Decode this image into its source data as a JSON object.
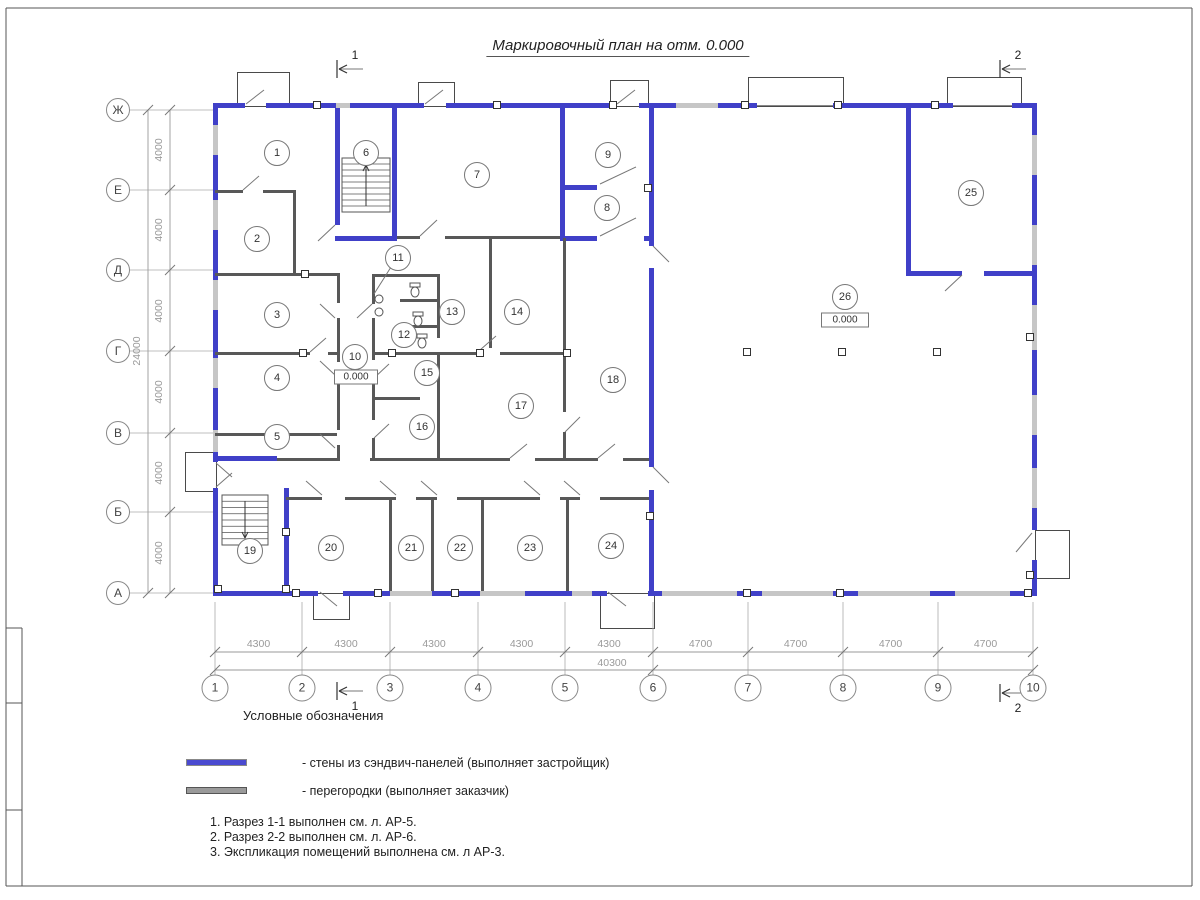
{
  "sheet": {
    "title": "Маркировочный план на отм. 0.000"
  },
  "legend": {
    "heading": "Условные обозначения",
    "items": [
      {
        "name": "sandwich-walls",
        "color": "#4040c8",
        "label": "- стены из сэндвич-панелей (выполняет застройщик)"
      },
      {
        "name": "partitions",
        "color": "#9a9a9a",
        "label": "- перегородки (выполняет заказчик)"
      }
    ]
  },
  "notes": [
    "1. Разрез 1-1 выполнен см. л. АР-5.",
    "2. Разрез 2-2 выполнен см. л. АР-6.",
    "3. Экспликация помещений выполнена см. л АР-3."
  ],
  "axes": {
    "rows": [
      {
        "label": "Ж",
        "y": 110
      },
      {
        "label": "Е",
        "y": 190
      },
      {
        "label": "Д",
        "y": 270
      },
      {
        "label": "Г",
        "y": 351
      },
      {
        "label": "В",
        "y": 433
      },
      {
        "label": "Б",
        "y": 512
      },
      {
        "label": "А",
        "y": 593
      }
    ],
    "cols": [
      {
        "label": "1",
        "x": 215
      },
      {
        "label": "2",
        "x": 302
      },
      {
        "label": "3",
        "x": 390
      },
      {
        "label": "4",
        "x": 478
      },
      {
        "label": "5",
        "x": 565
      },
      {
        "label": "6",
        "x": 653
      },
      {
        "label": "7",
        "x": 748
      },
      {
        "label": "8",
        "x": 843
      },
      {
        "label": "9",
        "x": 938
      },
      {
        "label": "10",
        "x": 1033
      }
    ]
  },
  "dimensions": {
    "bottom": {
      "seg_labels": [
        "4300",
        "4300",
        "4300",
        "4300",
        "4300",
        "4700",
        "4700",
        "4700",
        "4700"
      ],
      "total_label": "40300",
      "chain_y": 652,
      "total_y": 670,
      "total_label_x": 612
    },
    "left": {
      "seg_labels": [
        "4000",
        "4000",
        "4000",
        "4000",
        "4000",
        "4000"
      ],
      "total_label": "24000",
      "chain_x": 170,
      "total_x": 148,
      "total_label_y": 351
    }
  },
  "sections": [
    {
      "label": "1",
      "x": 337,
      "y": 69,
      "side": "top"
    },
    {
      "label": "2",
      "x": 1000,
      "y": 69,
      "side": "top"
    },
    {
      "label": "1",
      "x": 337,
      "y": 691,
      "side": "bottom"
    },
    {
      "label": "2",
      "x": 1000,
      "y": 693,
      "side": "bottom"
    }
  ],
  "elevations": [
    {
      "text": "0.000",
      "x": 356,
      "y": 377,
      "w": 36
    },
    {
      "text": "0.000",
      "x": 845,
      "y": 320,
      "w": 40
    }
  ],
  "rooms": [
    {
      "n": "1",
      "x": 277,
      "y": 153
    },
    {
      "n": "2",
      "x": 257,
      "y": 239
    },
    {
      "n": "3",
      "x": 277,
      "y": 315
    },
    {
      "n": "4",
      "x": 277,
      "y": 378
    },
    {
      "n": "5",
      "x": 277,
      "y": 437
    },
    {
      "n": "6",
      "x": 366,
      "y": 153
    },
    {
      "n": "7",
      "x": 477,
      "y": 175
    },
    {
      "n": "8",
      "x": 607,
      "y": 208
    },
    {
      "n": "9",
      "x": 608,
      "y": 155
    },
    {
      "n": "10",
      "x": 355,
      "y": 357
    },
    {
      "n": "11",
      "x": 398,
      "y": 258
    },
    {
      "n": "12",
      "x": 404,
      "y": 335
    },
    {
      "n": "13",
      "x": 452,
      "y": 312
    },
    {
      "n": "14",
      "x": 517,
      "y": 312
    },
    {
      "n": "15",
      "x": 427,
      "y": 373
    },
    {
      "n": "16",
      "x": 422,
      "y": 427
    },
    {
      "n": "17",
      "x": 521,
      "y": 406
    },
    {
      "n": "18",
      "x": 613,
      "y": 380
    },
    {
      "n": "19",
      "x": 250,
      "y": 551
    },
    {
      "n": "20",
      "x": 331,
      "y": 548
    },
    {
      "n": "21",
      "x": 411,
      "y": 548
    },
    {
      "n": "22",
      "x": 460,
      "y": 548
    },
    {
      "n": "23",
      "x": 530,
      "y": 548
    },
    {
      "n": "24",
      "x": 611,
      "y": 546
    },
    {
      "n": "25",
      "x": 971,
      "y": 193
    },
    {
      "n": "26",
      "x": 845,
      "y": 297
    }
  ],
  "geometry": {
    "frame": [
      [
        6,
        8,
        1192,
        8
      ],
      [
        6,
        8,
        6,
        886
      ],
      [
        1192,
        8,
        1192,
        886
      ],
      [
        6,
        886,
        1192,
        886
      ],
      [
        22,
        628,
        22,
        886
      ],
      [
        6,
        628,
        22,
        628
      ],
      [
        6,
        703,
        22,
        703
      ],
      [
        6,
        810,
        22,
        810
      ]
    ],
    "canopies": [
      [
        237,
        72,
        51,
        33
      ],
      [
        418,
        82,
        35,
        23
      ],
      [
        610,
        80,
        37,
        25
      ],
      [
        748,
        77,
        94,
        28
      ],
      [
        947,
        77,
        73,
        28
      ],
      [
        185,
        452,
        30,
        38
      ],
      [
        1035,
        530,
        33,
        47
      ],
      [
        313,
        593,
        35,
        25
      ],
      [
        600,
        593,
        53,
        34
      ]
    ],
    "windows": [
      [
        336,
        103,
        14,
        5
      ],
      [
        676,
        103,
        42,
        5
      ],
      [
        213,
        125,
        5,
        30
      ],
      [
        213,
        200,
        5,
        30
      ],
      [
        213,
        280,
        5,
        30
      ],
      [
        213,
        358,
        5,
        30
      ],
      [
        213,
        430,
        5,
        22
      ],
      [
        1032,
        135,
        5,
        40
      ],
      [
        1032,
        225,
        5,
        40
      ],
      [
        1032,
        305,
        5,
        45
      ],
      [
        1032,
        395,
        5,
        40
      ],
      [
        1032,
        468,
        5,
        40
      ],
      [
        390,
        591,
        42,
        5
      ],
      [
        480,
        591,
        45,
        5
      ],
      [
        572,
        591,
        20,
        5
      ],
      [
        662,
        591,
        75,
        5
      ],
      [
        762,
        591,
        71,
        5
      ],
      [
        858,
        591,
        72,
        5
      ],
      [
        955,
        591,
        55,
        5
      ]
    ],
    "walls_blue": [
      [
        215,
        103,
        30,
        5
      ],
      [
        266,
        103,
        70,
        5
      ],
      [
        350,
        103,
        74,
        5
      ],
      [
        446,
        103,
        170,
        5
      ],
      [
        639,
        103,
        37,
        5
      ],
      [
        718,
        103,
        39,
        5
      ],
      [
        833,
        103,
        120,
        5
      ],
      [
        1012,
        103,
        25,
        5
      ],
      [
        213,
        103,
        5,
        22
      ],
      [
        213,
        155,
        5,
        45
      ],
      [
        213,
        230,
        5,
        50
      ],
      [
        213,
        310,
        5,
        48
      ],
      [
        213,
        388,
        5,
        42
      ],
      [
        213,
        452,
        5,
        10
      ],
      [
        213,
        488,
        5,
        108
      ],
      [
        1032,
        103,
        5,
        32
      ],
      [
        1032,
        175,
        5,
        50
      ],
      [
        1032,
        265,
        5,
        40
      ],
      [
        1032,
        350,
        5,
        45
      ],
      [
        1032,
        435,
        5,
        33
      ],
      [
        1032,
        508,
        5,
        22
      ],
      [
        1032,
        560,
        5,
        36
      ],
      [
        215,
        591,
        103,
        5
      ],
      [
        343,
        591,
        47,
        5
      ],
      [
        432,
        591,
        48,
        5
      ],
      [
        525,
        591,
        47,
        5
      ],
      [
        592,
        591,
        15,
        5
      ],
      [
        648,
        591,
        14,
        5
      ],
      [
        737,
        591,
        25,
        5
      ],
      [
        833,
        591,
        25,
        5
      ],
      [
        930,
        591,
        25,
        5
      ],
      [
        1010,
        591,
        25,
        5
      ],
      [
        335,
        108,
        5,
        117
      ],
      [
        392,
        108,
        5,
        128
      ],
      [
        335,
        236,
        62,
        5
      ],
      [
        560,
        108,
        5,
        128
      ],
      [
        649,
        108,
        5,
        138
      ],
      [
        649,
        268,
        5,
        199
      ],
      [
        649,
        490,
        5,
        101
      ],
      [
        560,
        185,
        37,
        5
      ],
      [
        644,
        185,
        10,
        5
      ],
      [
        560,
        236,
        37,
        5
      ],
      [
        644,
        236,
        10,
        5
      ],
      [
        906,
        108,
        5,
        165
      ],
      [
        906,
        271,
        56,
        5
      ],
      [
        984,
        271,
        48,
        5
      ],
      [
        213,
        456,
        64,
        5
      ],
      [
        284,
        488,
        5,
        103
      ]
    ],
    "walls_gray": [
      [
        215,
        190,
        28,
        3
      ],
      [
        263,
        190,
        32,
        3
      ],
      [
        293,
        190,
        3,
        83
      ],
      [
        215,
        273,
        122,
        3
      ],
      [
        337,
        273,
        3,
        30
      ],
      [
        337,
        318,
        3,
        44
      ],
      [
        337,
        377,
        3,
        53
      ],
      [
        337,
        445,
        3,
        13
      ],
      [
        215,
        352,
        95,
        3
      ],
      [
        328,
        352,
        9,
        3
      ],
      [
        215,
        433,
        122,
        3
      ],
      [
        277,
        458,
        63,
        3
      ],
      [
        370,
        458,
        140,
        3
      ],
      [
        535,
        458,
        63,
        3
      ],
      [
        623,
        458,
        26,
        3
      ],
      [
        286,
        497,
        36,
        3
      ],
      [
        345,
        497,
        51,
        3
      ],
      [
        416,
        497,
        21,
        3
      ],
      [
        457,
        497,
        83,
        3
      ],
      [
        560,
        497,
        20,
        3
      ],
      [
        600,
        497,
        49,
        3
      ],
      [
        389,
        497,
        3,
        94
      ],
      [
        431,
        497,
        3,
        94
      ],
      [
        481,
        497,
        3,
        94
      ],
      [
        566,
        497,
        3,
        94
      ],
      [
        397,
        236,
        23,
        3
      ],
      [
        445,
        236,
        115,
        3
      ],
      [
        372,
        274,
        65,
        3
      ],
      [
        372,
        274,
        3,
        30
      ],
      [
        372,
        318,
        3,
        42
      ],
      [
        372,
        378,
        3,
        42
      ],
      [
        372,
        438,
        3,
        20
      ],
      [
        400,
        299,
        37,
        3
      ],
      [
        400,
        325,
        37,
        3
      ],
      [
        372,
        352,
        108,
        3
      ],
      [
        500,
        352,
        68,
        3
      ],
      [
        437,
        274,
        3,
        64
      ],
      [
        437,
        352,
        3,
        106
      ],
      [
        372,
        397,
        48,
        3
      ],
      [
        489,
        238,
        3,
        110
      ],
      [
        563,
        238,
        3,
        174
      ],
      [
        563,
        432,
        3,
        26
      ]
    ],
    "anchors": [
      [
        317,
        105
      ],
      [
        497,
        105
      ],
      [
        613,
        105
      ],
      [
        745,
        105
      ],
      [
        838,
        105
      ],
      [
        935,
        105
      ],
      [
        296,
        593
      ],
      [
        378,
        593
      ],
      [
        455,
        593
      ],
      [
        747,
        593
      ],
      [
        840,
        593
      ],
      [
        1028,
        593
      ],
      [
        218,
        589
      ],
      [
        286,
        589
      ],
      [
        1030,
        337
      ],
      [
        1030,
        575
      ],
      [
        747,
        352
      ],
      [
        842,
        352
      ],
      [
        937,
        352
      ],
      [
        392,
        353
      ],
      [
        480,
        353
      ],
      [
        567,
        353
      ],
      [
        303,
        353
      ],
      [
        305,
        274
      ],
      [
        650,
        516
      ],
      [
        648,
        188
      ],
      [
        286,
        532
      ]
    ],
    "leaves": [
      [
        246,
        104,
        264,
        90
      ],
      [
        425,
        104,
        443,
        90
      ],
      [
        617,
        104,
        635,
        90
      ],
      [
        1032,
        533,
        1016,
        552
      ],
      [
        320,
        592,
        337,
        606
      ],
      [
        608,
        592,
        626,
        606
      ],
      [
        216,
        463,
        232,
        477
      ],
      [
        216,
        487,
        232,
        473
      ],
      [
        335,
        225,
        318,
        241
      ],
      [
        420,
        236,
        437,
        220
      ],
      [
        600,
        184,
        636,
        167
      ],
      [
        600,
        236,
        636,
        218
      ],
      [
        653,
        246,
        669,
        262
      ],
      [
        653,
        467,
        669,
        483
      ],
      [
        962,
        275,
        945,
        291
      ],
      [
        335,
        318,
        320,
        304
      ],
      [
        335,
        375,
        320,
        361
      ],
      [
        335,
        448,
        320,
        434
      ],
      [
        310,
        352,
        326,
        338
      ],
      [
        374,
        378,
        389,
        364
      ],
      [
        374,
        438,
        389,
        424
      ],
      [
        372,
        304,
        357,
        318
      ],
      [
        510,
        458,
        527,
        444
      ],
      [
        598,
        458,
        615,
        444
      ],
      [
        243,
        190,
        259,
        176
      ],
      [
        322,
        495,
        306,
        481
      ],
      [
        396,
        495,
        380,
        481
      ],
      [
        437,
        495,
        421,
        481
      ],
      [
        540,
        495,
        524,
        481
      ],
      [
        580,
        495,
        564,
        481
      ],
      [
        480,
        350,
        496,
        336
      ],
      [
        565,
        432,
        580,
        417
      ],
      [
        391,
        267,
        374,
        294
      ]
    ],
    "gates": [
      [
        757,
        105.5,
        833,
        105.5
      ],
      [
        953,
        105.5,
        1012,
        105.5
      ]
    ],
    "stairs": [
      {
        "x": 342,
        "y": 158,
        "w": 48,
        "h": 54,
        "steps": 8,
        "arrow": "up"
      },
      {
        "x": 222,
        "y": 495,
        "w": 46,
        "h": 50,
        "steps": 7,
        "arrow": "down"
      }
    ],
    "wcs": [
      [
        410,
        283
      ],
      [
        413,
        312
      ],
      [
        417,
        334
      ]
    ],
    "sinks": [
      [
        379,
        299
      ],
      [
        379,
        312
      ]
    ]
  }
}
